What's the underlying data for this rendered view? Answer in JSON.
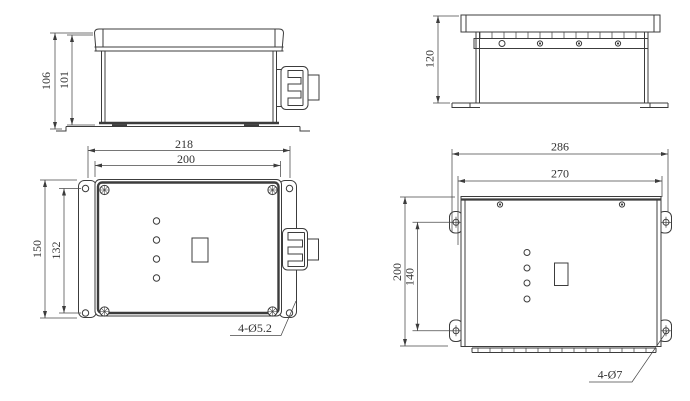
{
  "drawing": {
    "kind": "enclosure-dimension-drawing",
    "colors": {
      "line": "#3c3c3c",
      "text": "#333333",
      "background": "#ffffff"
    },
    "views": {
      "front_small": {
        "dims": {
          "overall_height": "106",
          "body_height": "101"
        }
      },
      "side_large": {
        "dims": {
          "height": "120"
        }
      },
      "top_small": {
        "dims": {
          "overall_width": "218",
          "body_width": "200",
          "overall_depth": "150",
          "hole_spacing": "132"
        },
        "hole_note": "4-Ø5.2"
      },
      "top_large": {
        "dims": {
          "overall_width": "286",
          "body_width": "270",
          "overall_depth": "200",
          "hole_spacing": "140"
        },
        "hole_note": "4-Ø7"
      }
    }
  }
}
